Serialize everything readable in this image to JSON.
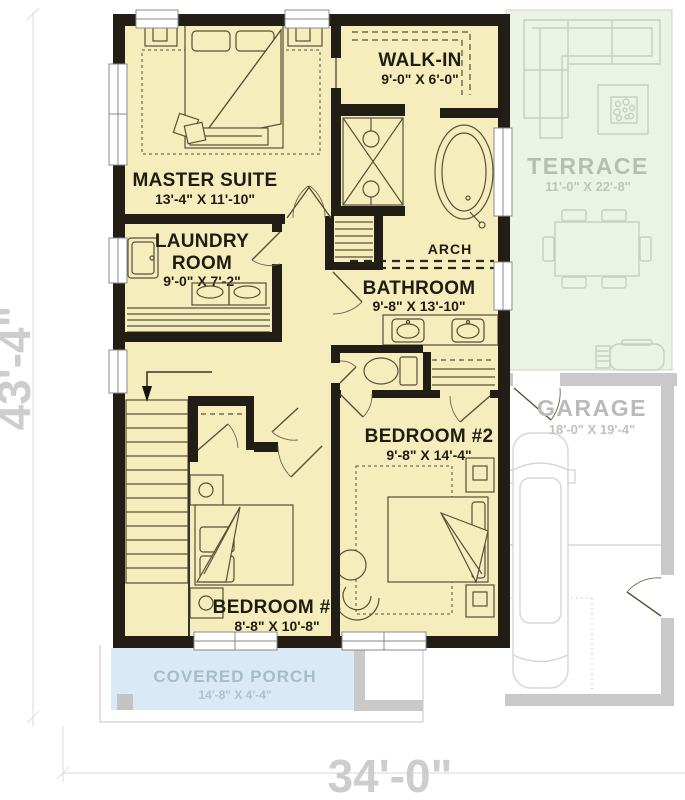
{
  "plan": {
    "title_hint": "second floor plan",
    "dimensions": {
      "height": "43'-4\"",
      "width": "34'-0\""
    },
    "arch_label": "ARCH",
    "rooms": {
      "master": {
        "name": "MASTER SUITE",
        "dims": "13'-4\" X 11'-10\""
      },
      "walkin": {
        "name": "WALK-IN",
        "dims": "9'-0\" X 6'-0\""
      },
      "laundry": {
        "name1": "LAUNDRY",
        "name2": "ROOM",
        "dims": "9'-0\" X 7'-2\""
      },
      "bathroom": {
        "name": "BATHROOM",
        "dims": "9'-8\" X 13'-10\""
      },
      "bedroom2": {
        "name": "BEDROOM #2",
        "dims": "9'-8\" X 14'-4\""
      },
      "bedroom3": {
        "name": "BEDROOM #3",
        "dims": "8'-8\" X 10'-8\""
      },
      "terrace": {
        "name": "TERRACE",
        "dims": "11'-0\" X 22'-8\""
      },
      "garage": {
        "name": "GARAGE",
        "dims": "18'-0\" X 19'-4\""
      },
      "porch": {
        "name": "COVERED PORCH",
        "dims": "14'-8\" X 4'-4\""
      }
    },
    "colors": {
      "floor": "#f5eebc",
      "wall": "#221e16",
      "terrace": "#eaf3e6",
      "porch": "#d9e9f6",
      "garage_wall": "#c9c9c9",
      "dim_text": "#cdcdcd"
    }
  }
}
